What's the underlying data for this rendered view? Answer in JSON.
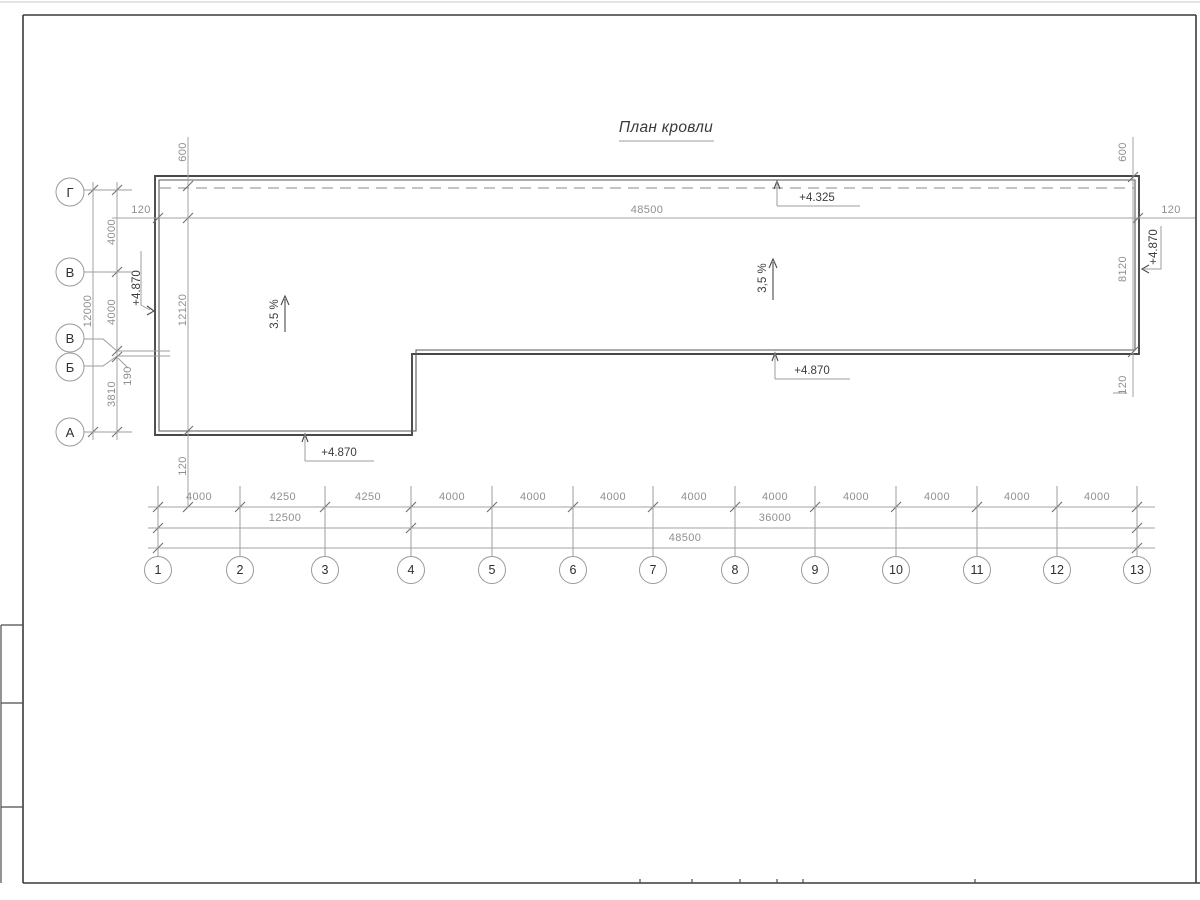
{
  "title": "План кровли",
  "top": {
    "left_120": "120",
    "total": "48500",
    "right_120": "120",
    "ridge_elevation": "+4.325"
  },
  "left": {
    "parapet_600": "600",
    "overall_12000": "12000",
    "seg_4000_a": "4000",
    "seg_4000_b": "4000",
    "seg_190": "190",
    "seg_3810": "3810",
    "roof_12120": "12120",
    "parapet_120": "120",
    "elevation": "+4.870",
    "axes": [
      "Г",
      "В",
      "В",
      "Б",
      "А"
    ]
  },
  "right": {
    "parapet_600": "600",
    "height_8120": "8120",
    "elevation": "+4.870",
    "bottom_120": "120"
  },
  "roof": {
    "slope_left": "3.5 %",
    "slope_right": "3,5 %",
    "elev_bottom_left": "+4.870",
    "elev_bottom_right": "+4.870"
  },
  "bottom": {
    "segments": [
      "4000",
      "4250",
      "4250",
      "4000",
      "4000",
      "4000",
      "4000",
      "4000",
      "4000",
      "4000",
      "4000",
      "4000"
    ],
    "subtotals": [
      "12500",
      "36000"
    ],
    "total": "48500",
    "axes": [
      "1",
      "2",
      "3",
      "4",
      "5",
      "6",
      "7",
      "8",
      "9",
      "10",
      "11",
      "12",
      "13"
    ]
  }
}
